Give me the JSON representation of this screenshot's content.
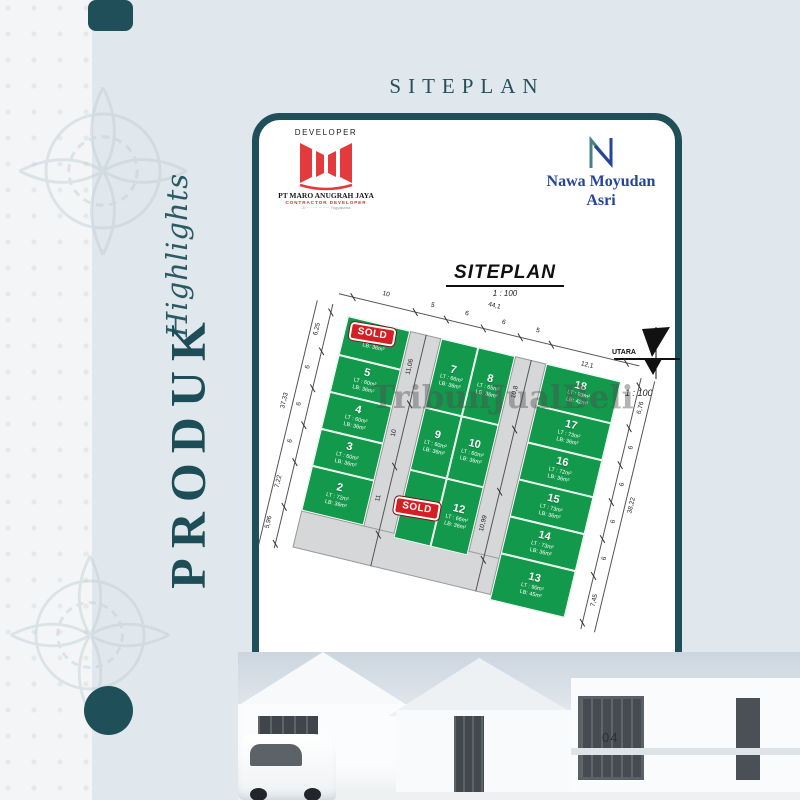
{
  "page": {
    "title": "SITEPLAN",
    "side_script": "Highlights",
    "side_main": "PRODUK",
    "page_number": "04"
  },
  "developer": {
    "label": "DEVELOPER",
    "company": "PT MARO ANUGRAH JAYA",
    "tagline": "CONTRACTOR DEVELOPER",
    "address": "Jl. ················· Yogyakarta"
  },
  "brand": {
    "line1": "Nawa Moyudan",
    "line2": "Asri"
  },
  "plan": {
    "title": "SITEPLAN",
    "scale": "1 : 100",
    "scale_note": "1 : 100",
    "compass": "UTARA",
    "watermark": "TribunJualBeli",
    "sold_label": "SOLD",
    "lots": [
      {
        "num": "6",
        "lt": "",
        "lb": "LB: 36m²",
        "sold": true
      },
      {
        "num": "5",
        "lt": "LT : 60m²",
        "lb": "LB: 36m²",
        "sold": false
      },
      {
        "num": "4",
        "lt": "LT : 60m²",
        "lb": "LB: 36m²",
        "sold": false
      },
      {
        "num": "3",
        "lt": "LT : 60m²",
        "lb": "LB: 36m²",
        "sold": false
      },
      {
        "num": "2",
        "lt": "LT : 72m²",
        "lb": "LB: 36m²",
        "sold": false
      },
      {
        "num": "7",
        "lt": "LT : 66m²",
        "lb": "LB: 36m²",
        "sold": false
      },
      {
        "num": "8",
        "lt": "LT : 65m²",
        "lb": "LB: 36m²",
        "sold": false
      },
      {
        "num": "9",
        "lt": "LT : 60m²",
        "lb": "LB: 36m²",
        "sold": false
      },
      {
        "num": "10",
        "lt": "LT : 60m²",
        "lb": "LB: 36m²",
        "sold": false
      },
      {
        "num": "11",
        "lt": "",
        "lb": "",
        "sold": true
      },
      {
        "num": "12",
        "lt": "LT : 66m²",
        "lb": "LB: 36m²",
        "sold": false
      },
      {
        "num": "18",
        "lt": "LT : 83m²",
        "lb": "LB: 42m²",
        "sold": false
      },
      {
        "num": "17",
        "lt": "LT : 73m²",
        "lb": "LB: 36m²",
        "sold": false
      },
      {
        "num": "16",
        "lt": "LT : 72m²",
        "lb": "LB: 36m²",
        "sold": false
      },
      {
        "num": "15",
        "lt": "LT : 73m²",
        "lb": "LB: 36m²",
        "sold": false
      },
      {
        "num": "14",
        "lt": "LT : 73m²",
        "lb": "LB: 36m²",
        "sold": false
      },
      {
        "num": "13",
        "lt": "LT : 90m²",
        "lb": "LB: 45m²",
        "sold": false
      }
    ],
    "dims": {
      "top": [
        "10",
        "5",
        "6",
        "6",
        "5"
      ],
      "top_total": "44,1",
      "top_right": "12,1",
      "left": [
        "6,25",
        "6",
        "6",
        "6"
      ],
      "left_outer": [
        "37,33",
        "7,22",
        "5,96"
      ],
      "right": [
        "6,76",
        "6",
        "6",
        "6",
        "6",
        "7,45"
      ],
      "right_total": "38,22",
      "road1": [
        "11,06",
        "10",
        "11"
      ],
      "road2": [
        "10,8",
        "10,99"
      ]
    }
  },
  "colors": {
    "teal": "#1f4f58",
    "lot_green": "#12994c",
    "sold_red": "#d41f24",
    "brand_blue": "#27449a",
    "logo_red": "#e23a3d"
  }
}
